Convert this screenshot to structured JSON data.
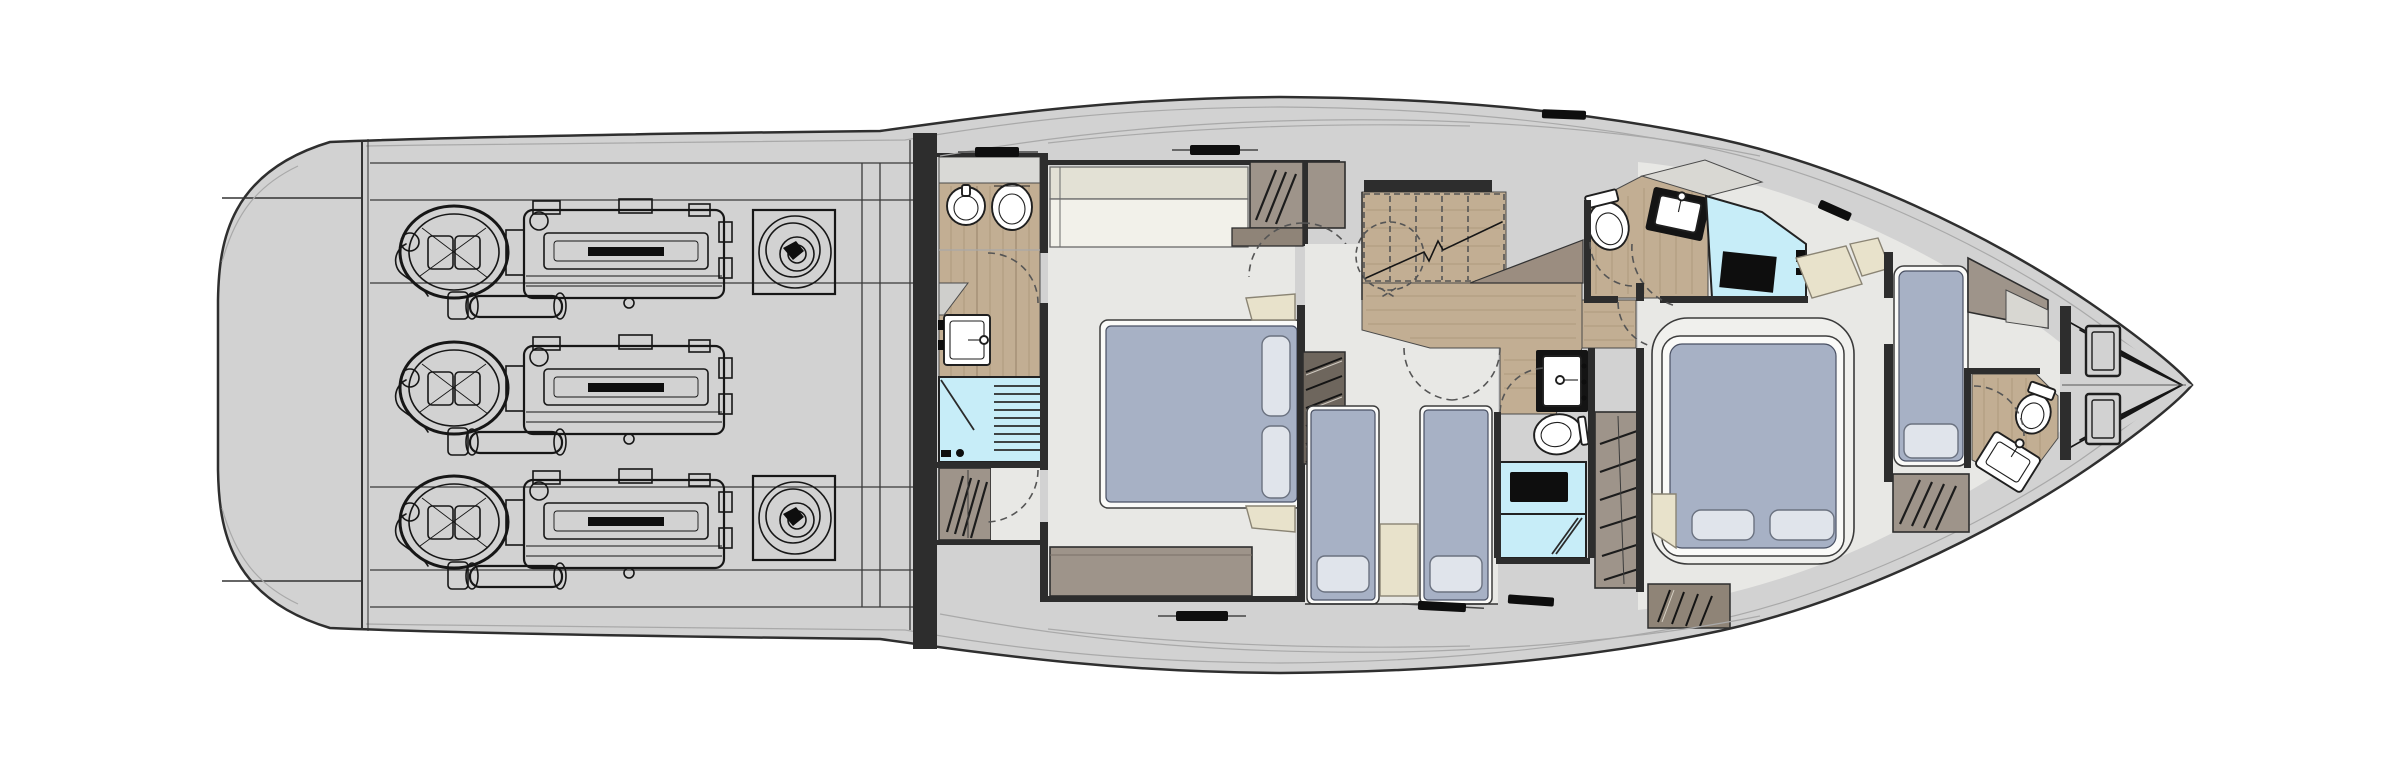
{
  "document": {
    "kind": "yacht-lower-deck-floor-plan",
    "view": "overhead plan, bow pointing right, no text labels in drawing"
  },
  "colors": {
    "paper": "#ffffff",
    "hull": "#d2d2d2",
    "hullLine": "#2f2f2f",
    "sheer": "#6f6f6f",
    "seam": "#a9a9a9",
    "wall": "#2d2d2d",
    "line": "#161616",
    "dash": "#555555",
    "floor": "#e8e8e5",
    "wood": "#c2ae93",
    "shower": "#c7edf8",
    "bed": "#a7b1c5",
    "pillow": "#e0e4eb",
    "cream": "#e8e2cb",
    "cabinet": "#9e948a",
    "cabinetDark": "#8f8478",
    "sofaBack": "#e3e1d5",
    "sofaSeat": "#f2f1ea",
    "black": "#0e0e0e"
  },
  "rooms": {
    "swim_platform": {
      "name": "Transom / swim platform garage"
    },
    "engine_room": {
      "name": "Engine room",
      "fixtures": [
        "engine-port",
        "engine-center",
        "engine-starboard",
        "stabilizer-port",
        "stabilizer-starboard"
      ]
    },
    "master_bathroom": {
      "name": "Master bathroom",
      "fixtures": [
        "bidet",
        "toilet",
        "washbasin",
        "shower",
        "wardrobe"
      ]
    },
    "master_cabin": {
      "name": "Master cabin (midship)",
      "fixtures": [
        "sofa",
        "wardrobe",
        "double-bed",
        "pillow",
        "pillow",
        "nightstand",
        "nightstand",
        "dresser"
      ]
    },
    "stair_lobby": {
      "name": "Staircase lobby",
      "fixtures": [
        "staircase",
        "understair-storage"
      ]
    },
    "twin_cabin": {
      "name": "Twin guest cabin",
      "fixtures": [
        "single-bed",
        "single-bed",
        "nightstand",
        "step-ladder"
      ]
    },
    "twin_bathroom": {
      "name": "Guest bathroom (day head)",
      "fixtures": [
        "washbasin",
        "toilet",
        "shower",
        "wardrobe"
      ]
    },
    "vip_bathroom": {
      "name": "VIP bathroom",
      "fixtures": [
        "toilet",
        "washbasin",
        "shower"
      ]
    },
    "vip_cabin": {
      "name": "VIP cabin (bow)",
      "fixtures": [
        "double-bed",
        "pillow",
        "pillow",
        "bench",
        "bench",
        "louvered-locker"
      ]
    },
    "crew_cabin": {
      "name": "Crew cabin",
      "fixtures": [
        "berth",
        "pillow",
        "wardrobe",
        "cabinet"
      ]
    },
    "crew_bathroom": {
      "name": "Crew bathroom",
      "fixtures": [
        "toilet",
        "washbasin"
      ]
    },
    "bow": {
      "name": "Anchor locker",
      "fixtures": [
        "deck-hatch",
        "deck-hatch"
      ]
    }
  }
}
